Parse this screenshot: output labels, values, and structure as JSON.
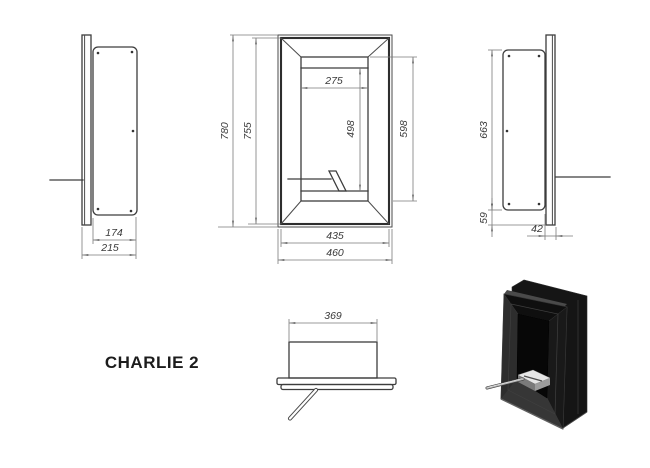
{
  "title": "CHARLIE 2",
  "dims": {
    "front": {
      "overall_height": "780",
      "inner_height": "755",
      "opening_width": "275",
      "opening_inner_height": "498",
      "opening_height": "598",
      "inner_width": "435",
      "overall_width": "460"
    },
    "left": {
      "box_depth": "174",
      "total_depth": "215"
    },
    "right": {
      "box_height": "663",
      "base_offset": "59",
      "front_depth": "42"
    },
    "top": {
      "box_width": "369"
    }
  }
}
